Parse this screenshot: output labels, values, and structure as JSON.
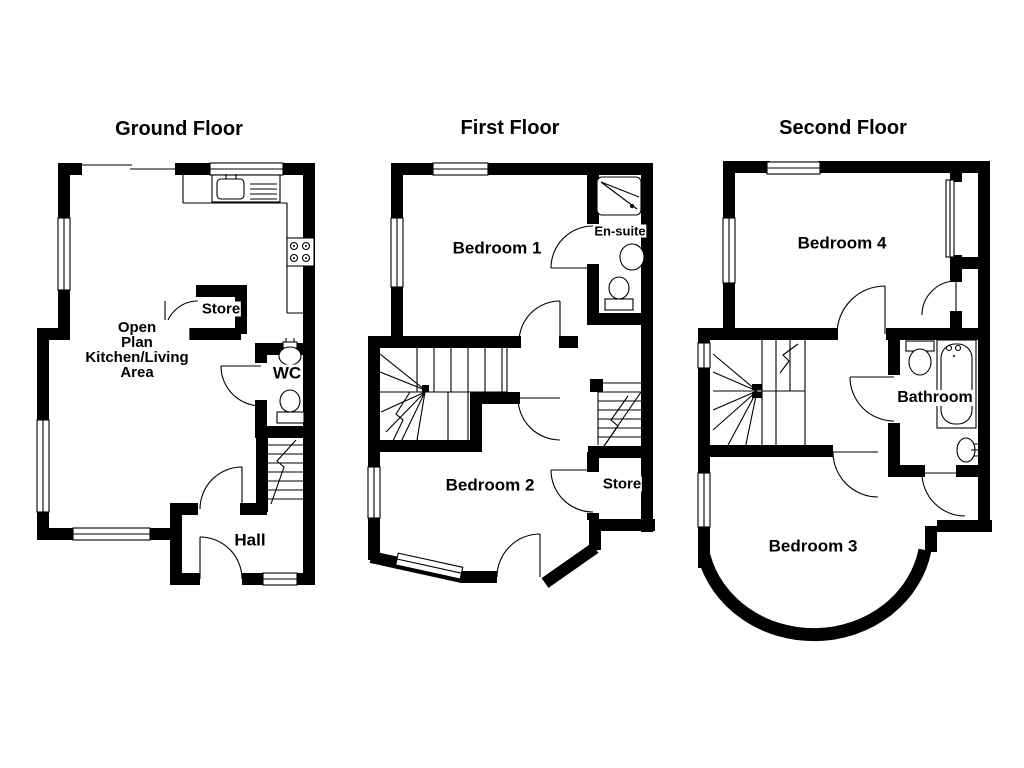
{
  "page": {
    "background": "#ffffff",
    "wall_color": "#000000",
    "line_color": "#000000"
  },
  "floors": [
    {
      "id": "ground",
      "title": "Ground Floor",
      "rooms": [
        {
          "id": "open-plan",
          "label": "Open\nPlan\nKitchen/Living\nArea"
        },
        {
          "id": "store",
          "label": "Store"
        },
        {
          "id": "wc",
          "label": "WC"
        },
        {
          "id": "hall",
          "label": "Hall"
        }
      ],
      "fixtures": [
        "kitchen-sink-drainer",
        "hob",
        "kitchen-counter",
        "wc-hand-basin",
        "wc-toilet",
        "staircase",
        "entrance-door",
        "windows"
      ]
    },
    {
      "id": "first",
      "title": "First Floor",
      "rooms": [
        {
          "id": "bedroom-1",
          "label": "Bedroom 1"
        },
        {
          "id": "en-suite",
          "label": "En-suite"
        },
        {
          "id": "bedroom-2",
          "label": "Bedroom 2"
        },
        {
          "id": "store",
          "label": "Store"
        }
      ],
      "fixtures": [
        "shower",
        "en-suite-basin",
        "en-suite-toilet",
        "staircase-down",
        "staircase-up",
        "windows"
      ]
    },
    {
      "id": "second",
      "title": "Second Floor",
      "rooms": [
        {
          "id": "bedroom-4",
          "label": "Bedroom 4"
        },
        {
          "id": "bathroom",
          "label": "Bathroom"
        },
        {
          "id": "bedroom-3",
          "label": "Bedroom 3"
        }
      ],
      "fixtures": [
        "bath",
        "bathroom-toilet",
        "bathroom-basin",
        "staircase",
        "bow-window-wall",
        "windows"
      ]
    }
  ]
}
